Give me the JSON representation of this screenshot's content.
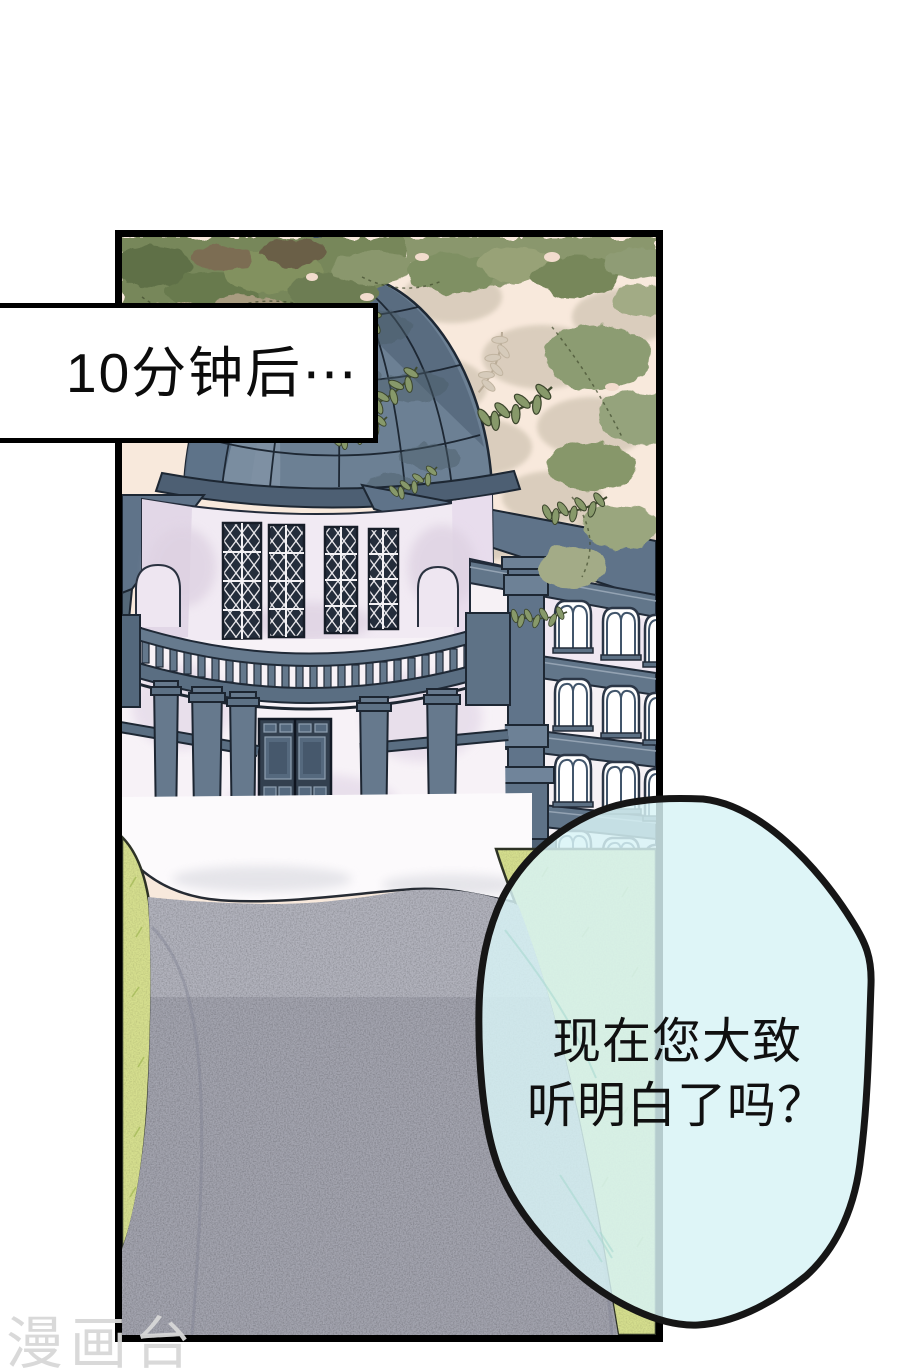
{
  "caption": {
    "text": "10分钟后⋯"
  },
  "bubble": {
    "line1": "现在您大致",
    "line2": "听明白了吗？"
  },
  "watermark": {
    "text": "漫画台"
  },
  "palette": {
    "panel_border": "#000000",
    "sky": "#f8e9dc",
    "dome_slate": "#6c8094",
    "wall_lavender": "#f1eaf3",
    "wing_wall": "#f6f1f5",
    "grass": "#d5de8e",
    "path_gray": "#a9abb6",
    "foliage_green": "#77875a",
    "ink_outline": "#1d2733",
    "bubble_fill": "#d8f3f5",
    "bubble_outline": "#161616",
    "watermark_gray": "#d8d8d8"
  }
}
